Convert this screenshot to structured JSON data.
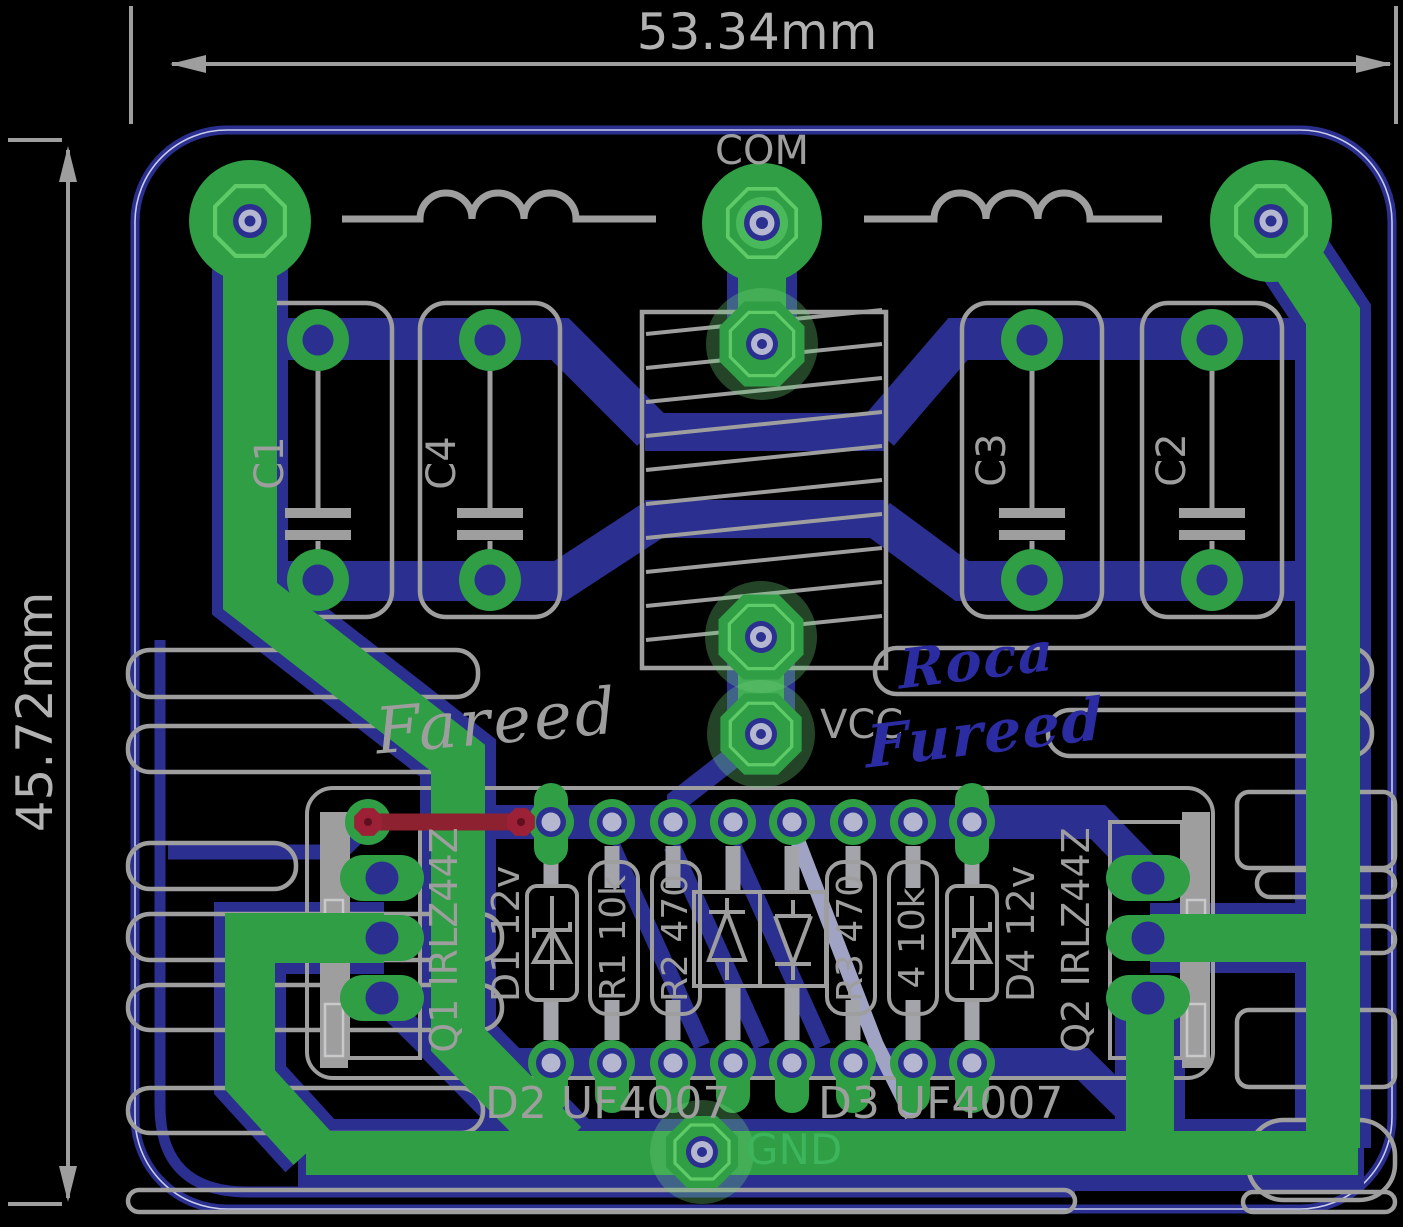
{
  "dimensions": {
    "width": "53.34mm",
    "height": "45.72mm"
  },
  "nets": {
    "com": "COM",
    "vcc": "VCC",
    "gnd": "GND"
  },
  "silkscreen": {
    "c1": "C1",
    "c4": "C4",
    "c3": "C3",
    "c2": "C2",
    "q1": "Q1 IRLZ44Z",
    "q2": "Q2 IRLZ44Z",
    "d1": "D1 12v",
    "d4": "D4 12v",
    "r1": "R1 10k",
    "r2": "R2 470",
    "r3": "R3 470",
    "r4": "4 10k",
    "d2": "D2 UF4007",
    "d3": "D3 UF4007"
  },
  "signatures": {
    "silkscreen_author": "Fareed",
    "copper_line1": "Roca",
    "copper_line2": "Fureed"
  },
  "colors": {
    "background": "#000000",
    "copper_top_green": "#2f9e44",
    "copper_bottom_blue": "#2a2f90",
    "silkscreen_gray": "#9e9e9e",
    "highlight_red": "#8e2130",
    "hole_lavender": "#b4b7cf",
    "gnd_label_green": "#3cb55c"
  }
}
